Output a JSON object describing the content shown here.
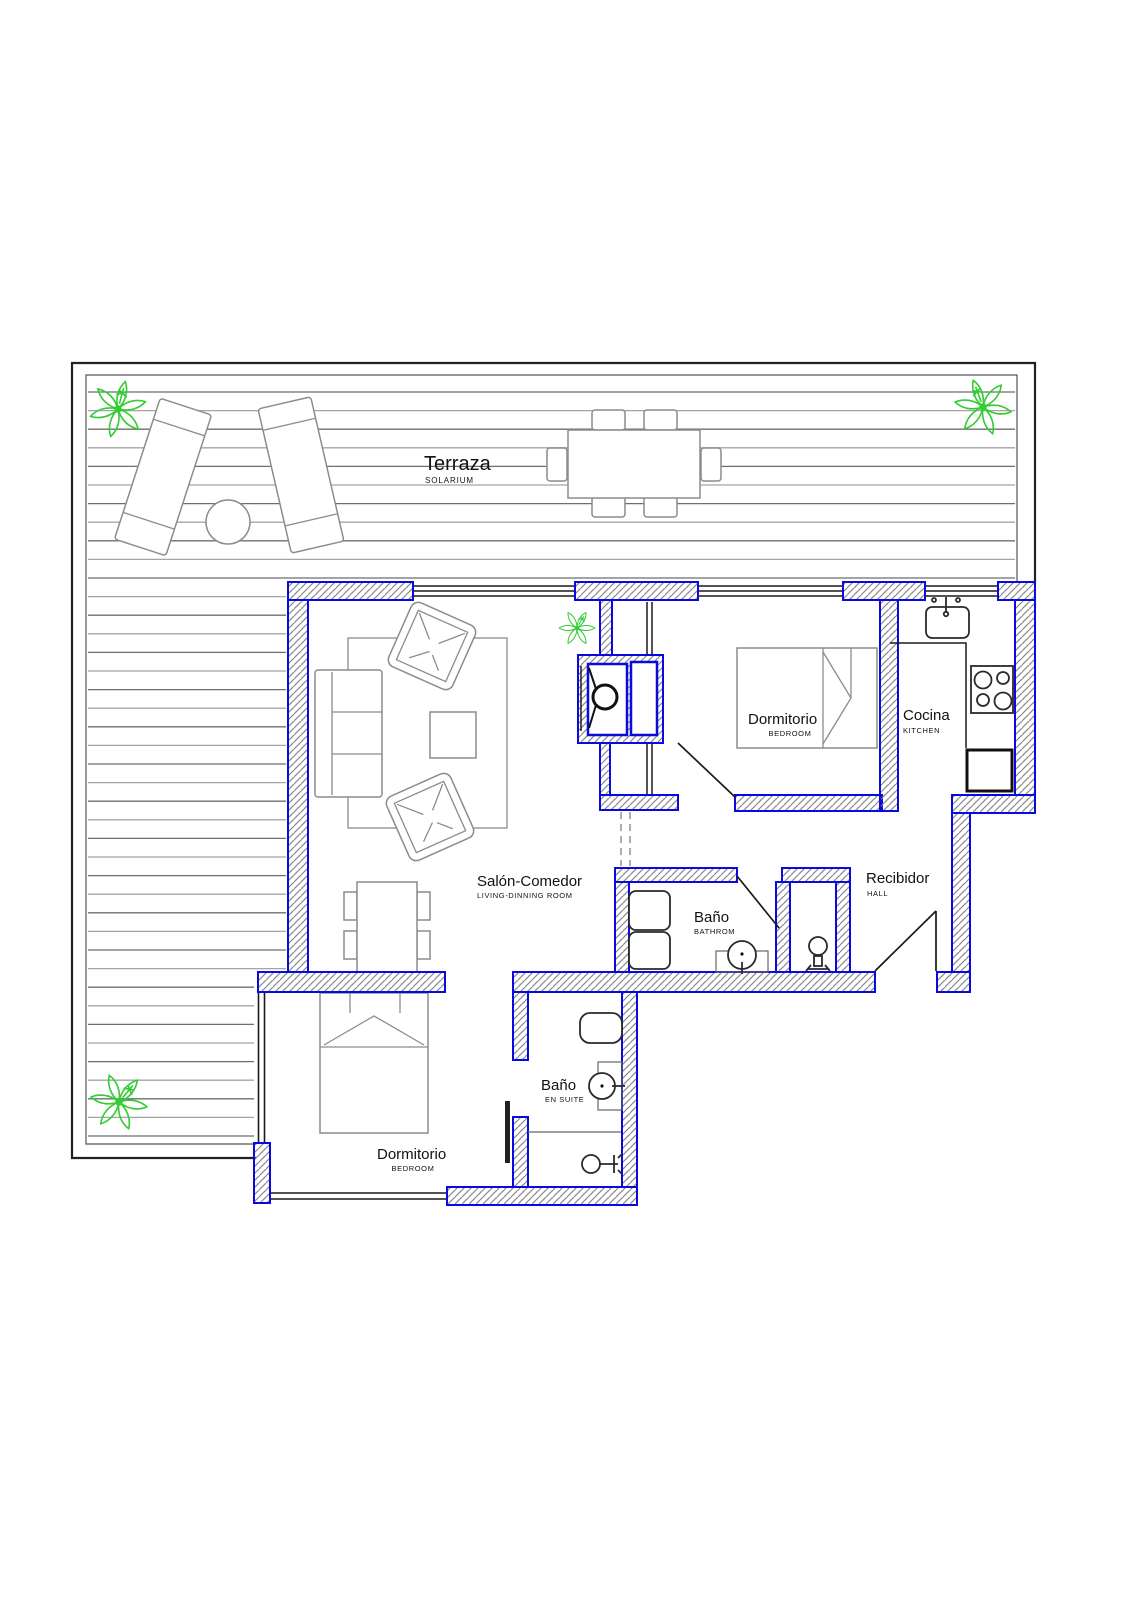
{
  "colors": {
    "wall_blue": "#0a0ae0",
    "hatch_gray": "#8a8a8a",
    "line_black": "#1a1a1a",
    "furn_gray": "#8c8c8c",
    "fixture_dark": "#2a2a2a",
    "deck_a": "#6e6e6e",
    "deck_b": "#a4a4a4",
    "plant_green": "#33cc33"
  },
  "rooms": {
    "terraza": {
      "name": "Terraza",
      "type": "SOLARIUM"
    },
    "salon_comedor": {
      "name": "Salón-Comedor",
      "type": "LIVING-DINNING ROOM"
    },
    "dormitorio_1": {
      "name": "Dormitorio",
      "type": "BEDROOM"
    },
    "cocina": {
      "name": "Cocina",
      "type": "KITCHEN"
    },
    "recibidor": {
      "name": "Recibidor",
      "type": "HALL"
    },
    "bano": {
      "name": "Baño",
      "type": "BATHROM"
    },
    "dormitorio_2": {
      "name": "Dormitorio",
      "type": "BEDROOM"
    },
    "bano_ensuite": {
      "name": "Baño",
      "type": "EN SUITE"
    }
  }
}
